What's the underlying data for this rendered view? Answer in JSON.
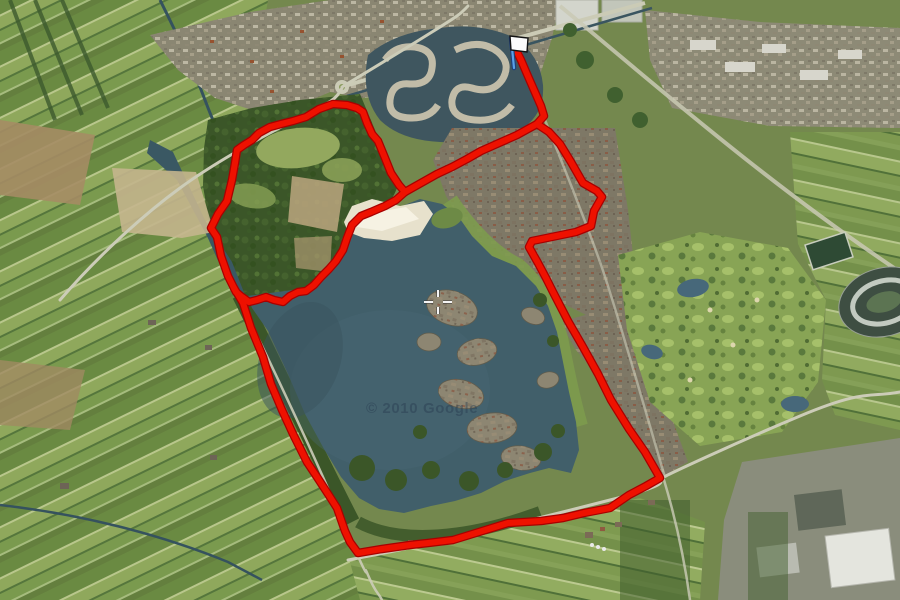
{
  "map": {
    "type": "satellite-map-with-gps-route",
    "watermark": "© 2010 Google",
    "track": {
      "color": "#ee1100",
      "outline_color": "#a80000",
      "width": 6,
      "outline_width": 8.5,
      "segments": [
        {
          "name": "start-spur",
          "points": [
            [
              517,
              52
            ],
            [
              521,
              60
            ],
            [
              527,
              74
            ],
            [
              534,
              90
            ],
            [
              541,
              106
            ],
            [
              544,
              116
            ],
            [
              537,
              124
            ]
          ]
        },
        {
          "name": "east-loop",
          "points": [
            [
              537,
              124
            ],
            [
              549,
              132
            ],
            [
              560,
              144
            ],
            [
              571,
              162
            ],
            [
              583,
              183
            ],
            [
              597,
              191
            ],
            [
              602,
              197
            ],
            [
              594,
              211
            ],
            [
              591,
              226
            ],
            [
              576,
              232
            ],
            [
              532,
              241
            ],
            [
              529,
              247
            ],
            [
              538,
              263
            ],
            [
              546,
              278
            ],
            [
              553,
              292
            ],
            [
              568,
              321
            ],
            [
              583,
              347
            ],
            [
              598,
              374
            ],
            [
              611,
              400
            ],
            [
              629,
              429
            ],
            [
              645,
              452
            ],
            [
              660,
              478
            ],
            [
              646,
              486
            ],
            [
              629,
              495
            ],
            [
              610,
              508
            ],
            [
              584,
              513
            ],
            [
              563,
              518
            ],
            [
              541,
              521
            ],
            [
              508,
              523
            ],
            [
              479,
              532
            ],
            [
              453,
              540
            ],
            [
              428,
              543
            ],
            [
              410,
              545
            ],
            [
              382,
              549
            ],
            [
              358,
              553
            ],
            [
              350,
              542
            ],
            [
              345,
              531
            ],
            [
              337,
              508
            ],
            [
              330,
              497
            ],
            [
              317,
              477
            ],
            [
              307,
              462
            ],
            [
              293,
              434
            ],
            [
              282,
              410
            ],
            [
              271,
              384
            ],
            [
              263,
              357
            ],
            [
              251,
              328
            ],
            [
              243,
              303
            ],
            [
              234,
              288
            ]
          ]
        },
        {
          "name": "park-loop",
          "points": [
            [
              234,
              288
            ],
            [
              228,
              276
            ],
            [
              221,
              256
            ],
            [
              217,
              237
            ],
            [
              211,
              228
            ],
            [
              218,
              214
            ],
            [
              227,
              201
            ],
            [
              232,
              180
            ],
            [
              235,
              163
            ],
            [
              237,
              150
            ],
            [
              244,
              145
            ],
            [
              252,
              140
            ],
            [
              259,
              133
            ],
            [
              270,
              127
            ],
            [
              281,
              124
            ],
            [
              293,
              121
            ],
            [
              306,
              117
            ],
            [
              319,
              109
            ],
            [
              333,
              104
            ],
            [
              347,
              105
            ],
            [
              357,
              108
            ],
            [
              363,
              112
            ],
            [
              367,
              123
            ],
            [
              372,
              134
            ],
            [
              378,
              141
            ],
            [
              385,
              158
            ],
            [
              391,
              173
            ],
            [
              399,
              185
            ],
            [
              405,
              192
            ],
            [
              396,
              200
            ],
            [
              385,
              206
            ],
            [
              371,
              212
            ],
            [
              361,
              216
            ],
            [
              352,
              225
            ],
            [
              347,
              238
            ],
            [
              343,
              250
            ],
            [
              336,
              261
            ],
            [
              329,
              269
            ],
            [
              321,
              277
            ],
            [
              314,
              285
            ],
            [
              306,
              291
            ],
            [
              298,
              292
            ],
            [
              290,
              296
            ],
            [
              283,
              302
            ],
            [
              274,
              300
            ],
            [
              266,
              297
            ],
            [
              257,
              300
            ],
            [
              249,
              302
            ],
            [
              242,
              297
            ],
            [
              236,
              292
            ],
            [
              234,
              288
            ]
          ]
        },
        {
          "name": "connector",
          "points": [
            [
              537,
              124
            ],
            [
              517,
              135
            ],
            [
              499,
              143
            ],
            [
              481,
              151
            ],
            [
              467,
              159
            ],
            [
              452,
              167
            ],
            [
              437,
              174
            ],
            [
              421,
              183
            ],
            [
              405,
              192
            ]
          ]
        }
      ]
    },
    "marker": {
      "kind": "start-finish-flag",
      "x": 514,
      "y": 68,
      "pole_color": "#5aa0e8",
      "pole_outline": "#1e3f7a",
      "flag_fill": "#fbfbfb",
      "flag_outline": "#121212"
    },
    "crosshair": {
      "x": 438,
      "y": 302,
      "color": "#f4f4f4",
      "halo": "#3c3c3c"
    }
  }
}
